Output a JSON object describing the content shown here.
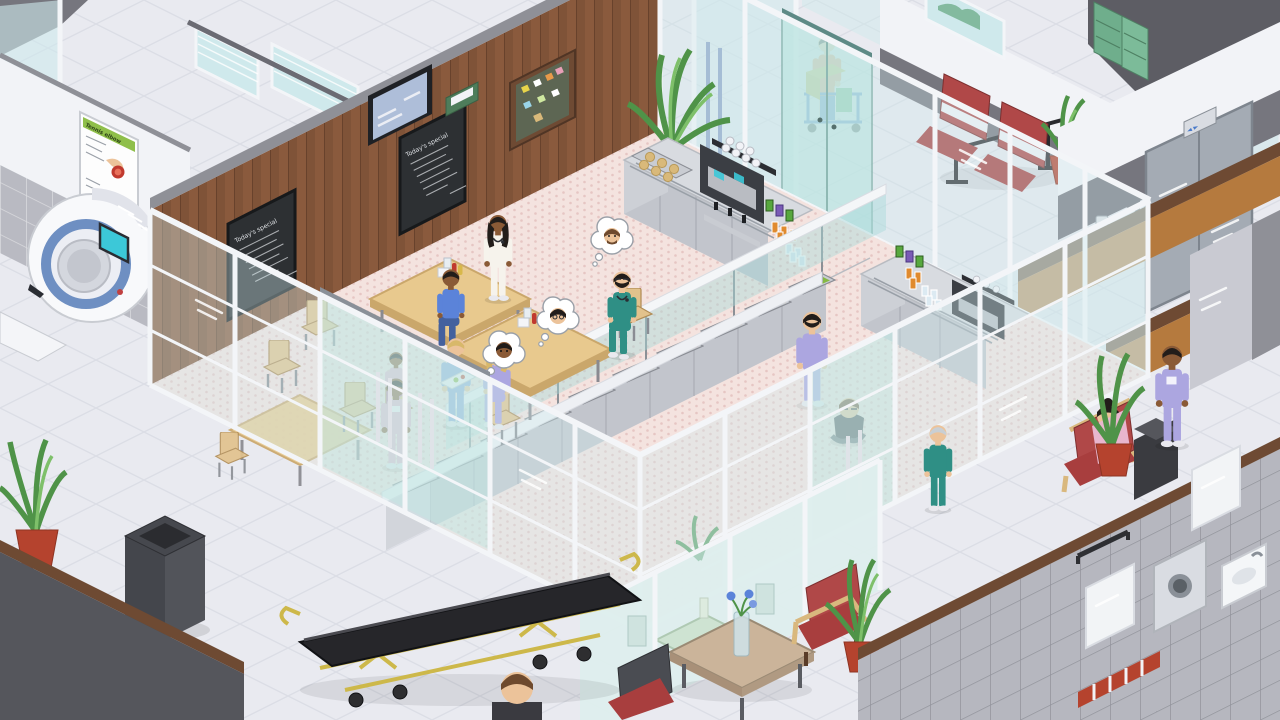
{
  "signs": {
    "poster_title": "Tennis elbow",
    "blackboard_title": "Today's special",
    "elevator_sign": "◄ ►"
  },
  "palette": {
    "floor": "#e9eaf0",
    "floor-line": "#dbdde5",
    "caf-floor": "#f4e3df",
    "caf-dot": "#e6c6c3",
    "wood": "#8a5a3d",
    "wood-cap": "#8f9097",
    "wood-trim": "#6e4a33",
    "warm-wood": "#b57a3e",
    "wall-white": "#f2f3f7",
    "wall-gray": "#c9cad2",
    "wall-dark": "#5d5d64",
    "wall-band": "#76767e",
    "tile-wall": "#b9bac2",
    "bath-tile": "#b6b7bf",
    "glass": "#cfe9ec",
    "glass-door": "#bfe6e2",
    "frame": "#f3f5f8",
    "counter-top": "#d8dbe0",
    "counter-front": "#c2c5cc",
    "steel": "#8a8d94",
    "machine-dark": "#3b3e44",
    "blackboard": "#2d3033",
    "chalk": "#dfe2e6",
    "food-green": "#86b944",
    "food-red": "#c24b38",
    "food-orange": "#d08a30",
    "food-olive": "#9a9a40",
    "food-yellow": "#d2bc4e",
    "donut-pink": "#e891a8",
    "muffin": "#d9b97a",
    "table-wood": "#e8c98e",
    "table-edge": "#caa76b",
    "chair-wood": "#e2c28c",
    "scrub-teal": "#2f8f85",
    "scrub-blue": "#5b83d9",
    "scrub-blue-light": "#8aa8dc",
    "scrub-lavender": "#aca6e0",
    "scrub-pink": "#e8b6ce",
    "nurse-white": "#f6f3ec",
    "janitor-orange": "#e8935e",
    "red-chair": "#b04848",
    "red-cushion": "#a83e3e",
    "plant": "#4f9348",
    "plant-light": "#7ec06a",
    "pot-red": "#b5432e",
    "stretcher-yellow": "#cdb84a",
    "stretcher-dark": "#26262a",
    "bin-dark": "#46484e",
    "elevator-door": "#a4abb4",
    "ct-blue": "#6e8fc2",
    "ct-screen": "#3cc8d8",
    "skin-light": "#ecc39a",
    "skin-tan": "#d9a06b",
    "skin-dark": "#8a5a36",
    "hair-dark": "#221d1a",
    "hair-brown": "#6e4a2e",
    "hair-blonde": "#d8b86a"
  },
  "entities": {
    "characters": [
      {
        "name": "nurse-white-standing",
        "outfit": "white uniform"
      },
      {
        "name": "doctor-teal-seated",
        "outfit": "teal scrubs"
      },
      {
        "name": "staff-blue-seated",
        "outfit": "blue top"
      },
      {
        "name": "nurse-lavender-seated",
        "outfit": "lavender scrubs"
      },
      {
        "name": "child-pink-seated",
        "outfit": "pink top"
      },
      {
        "name": "nurse-pink-standing",
        "outfit": "pink scrubs"
      },
      {
        "name": "nurse-blue-with-tray",
        "outfit": "light blue scrubs"
      },
      {
        "name": "doctor-lavender-walking",
        "outfit": "lavender scrubs"
      },
      {
        "name": "child-sitting-on-floor",
        "outfit": "dark tee"
      },
      {
        "name": "janitor-orange",
        "outfit": "orange uniform"
      },
      {
        "name": "nurse-lavender-corridor",
        "outfit": "lavender scrubs"
      },
      {
        "name": "staff-teal-lower-corridor",
        "outfit": "teal scrubs"
      },
      {
        "name": "patient-pink-on-sofa",
        "outfit": "pink top"
      },
      {
        "name": "patient-head-bottom",
        "outfit": "dark top"
      }
    ],
    "objects": [
      "ct-scanner",
      "wall-poster",
      "window-blinds",
      "wall-tv",
      "notice-board",
      "menu-blackboard",
      "coffee-machine",
      "muffin-tray",
      "soda-cans",
      "juice-glasses",
      "water-glasses",
      "drinks-counter",
      "buffet-counter",
      "sneeze-guard",
      "donut-tray",
      "dining-table",
      "wooden-chair",
      "condiment-set",
      "glass-sliding-door",
      "janitor-cart",
      "waiting-bench-red",
      "elevator",
      "elevator-call-button",
      "potted-plant",
      "trash-bin",
      "stretcher",
      "side-table",
      "flower-vase",
      "red-armchair",
      "red-sofa",
      "storage-box",
      "bathroom-mirror",
      "washing-machine",
      "sink",
      "handrail",
      "mint-table",
      "green-cabinet"
    ],
    "food_trays": [
      "donuts",
      "green salad",
      "tomatoes",
      "roast vegetables",
      "green salad",
      "olives",
      "tomato stew",
      "carrots",
      "corn",
      "green salad"
    ]
  },
  "thought_bubbles": [
    {
      "face": "bearded-man"
    },
    {
      "face": "woman-with-glasses"
    },
    {
      "face": "dark-haired-boy"
    }
  ]
}
